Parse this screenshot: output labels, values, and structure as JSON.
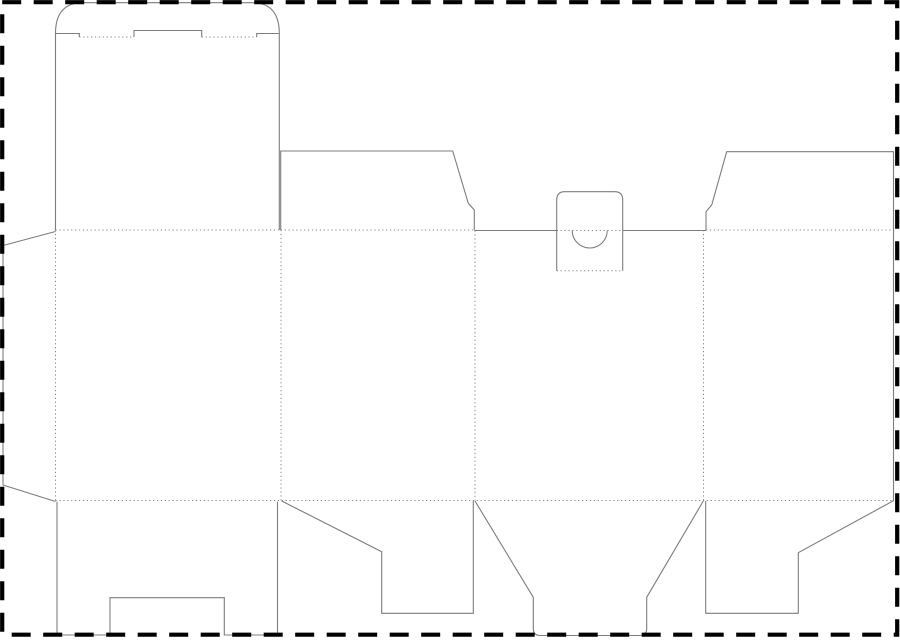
{
  "canvas": {
    "width": 900,
    "height": 641,
    "background": "#ffffff"
  },
  "styles": {
    "cut_color": "#7d7d7d",
    "cut_width": 1.1,
    "fold_color": "#8a8a8a",
    "fold_width": 1,
    "fold_dash": "1.3 2.6",
    "border_color": "#000000",
    "border_width": 4.2,
    "border_dash": "19 12.5"
  },
  "border": {
    "x": 2.2,
    "y": 2.2,
    "width": 895,
    "height": 632.5
  },
  "dieline": {
    "cuts": [
      {
        "name": "lid-flap-outline",
        "d": "M 55.5 33.5 Q 55.5 2.7 83 2.7 L 252 2.7 Q 279.3 2.7 279.3 33.5"
      },
      {
        "name": "lid-slit-left",
        "d": "M 55.5 33.5 L 79.3 33.5 L 79.3 37"
      },
      {
        "name": "lid-lock-tab",
        "d": "M 134 37 L 134 30.5 L 201.7 30.5 L 201.7 37"
      },
      {
        "name": "lid-slit-right",
        "d": "M 256.7 37 L 256.7 33.5 L 279.3 33.5"
      },
      {
        "name": "front-top-panel-left-edge",
        "d": "M 55.5 33.5 L 55.5 230"
      },
      {
        "name": "front-top-panel-right-edge",
        "d": "M 279.3 33.5 L 279.3 230"
      },
      {
        "name": "glue-flap-outline",
        "d": "M 55.5 231.5 L 3 245.5 L 3 485 L 55.5 501.5"
      },
      {
        "name": "top-dust-flap-left-outline",
        "d": "M 280.7 230 L 280.7 151 L 452.7 151 L 468.3 203.3 L 474.3 210 L 474.3 230"
      },
      {
        "name": "top-cut-edge-left-of-tuck",
        "d": "M 474.3 230.5 L 556.7 230.5"
      },
      {
        "name": "top-cut-edge-right-of-tuck",
        "d": "M 622.7 230.5 L 706 230.5"
      },
      {
        "name": "tuck-tab-outline",
        "d": "M 556.7 270.7 L 556.7 200 Q 556.7 191.7 564.7 191.7 L 614.7 191.7 Q 622.7 191.7 622.7 200 L 622.7 270.7"
      },
      {
        "name": "thumb-hole-arc",
        "d": "M 572.2 230.5 A 17.5 17.5 0 0 0 607.2 230.5"
      },
      {
        "name": "right-panel-and-flaps-outline",
        "d": "M 706 230 L 706 211.7 L 711.7 205 L 726.7 151.7 L 893.5 151.7 L 893.5 500.7 L 798.3 552.7 L 798.3 613.3 L 705.7 613.3 L 705.7 501"
      },
      {
        "name": "bottom-front-flap-outline",
        "d": "M 57 501.7 L 57 635 L 110 635 L 110 597.7 L 224.3 597.7 L 224.3 635 L 277.5 635 L 277.5 501.7"
      },
      {
        "name": "bottom-dust-flap-left-outline",
        "d": "M 281.7 501 L 381.7 551.7 L 381.7 613.3 L 473.3 613.3 L 473.3 501"
      },
      {
        "name": "bottom-tuck-flap-outline",
        "d": "M 475 501 L 533.3 597.3 L 533.3 628.5 Q 533.3 635.5 540.3 635.5 L 639.7 635.5 Q 646.7 635.5 646.7 628.5 L 646.7 597.3 L 703.3 501"
      }
    ],
    "folds": [
      {
        "name": "lid-fold-left",
        "d": "M 79.3 37 L 134 37"
      },
      {
        "name": "lid-fold-right",
        "d": "M 201.7 37 L 256.7 37"
      },
      {
        "name": "body-top-fold-panel-1",
        "d": "M 55.5 230 L 279.3 230"
      },
      {
        "name": "body-top-fold-panel-2",
        "d": "M 280.7 230 L 473.3 230"
      },
      {
        "name": "tuck-tab-fold",
        "d": "M 556.7 230.5 L 622.7 230.5"
      },
      {
        "name": "body-top-fold-panel-4",
        "d": "M 706 230 L 893.5 230"
      },
      {
        "name": "tuck-tab-tip-fold",
        "d": "M 556.7 270.7 L 622.7 270.7"
      },
      {
        "name": "vertical-fold-glue-edge",
        "d": "M 55.5 230 L 55.5 500.5"
      },
      {
        "name": "vertical-fold-panel-1-2",
        "d": "M 281 230 L 281 500.5"
      },
      {
        "name": "vertical-fold-panel-2-3",
        "d": "M 475 230.5 L 475 500.5"
      },
      {
        "name": "vertical-fold-panel-3-4",
        "d": "M 703.5 230 L 703.5 500.5"
      },
      {
        "name": "body-bottom-fold",
        "d": "M 55.5 500.5 L 893.5 500.5"
      }
    ]
  }
}
